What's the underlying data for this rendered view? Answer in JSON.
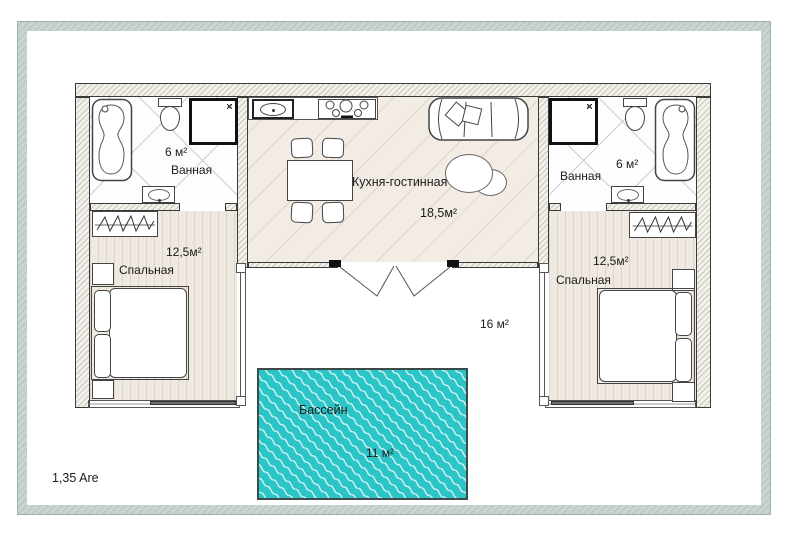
{
  "plot": {
    "area_label": "1,35 Are"
  },
  "rooms": {
    "bathroom_left": {
      "name": "Ванная",
      "area": "6 м²"
    },
    "bathroom_right": {
      "name": "Ванная",
      "area": "6 м²"
    },
    "kitchen_living": {
      "name": "Кухня-гостинная",
      "area": "18,5м²"
    },
    "bedroom_left": {
      "name": "Спальная",
      "area": "12,5м²"
    },
    "bedroom_right": {
      "name": "Спальная",
      "area": "12,5м²"
    },
    "terrace": {
      "area": "16 м²"
    },
    "pool": {
      "name": "Бассейн",
      "area": "11 м²"
    }
  },
  "colors": {
    "pool": "#2cc5c7",
    "pool_wave": "#e4f9f9",
    "floor": "#f2ece4",
    "bedroom_floor": "#efe9e1",
    "wall_fill": "#f3f1ec",
    "wall_hatch": "#cbc5ba",
    "plot_border": "#b7c6c2",
    "line": "#3a3a3a"
  }
}
